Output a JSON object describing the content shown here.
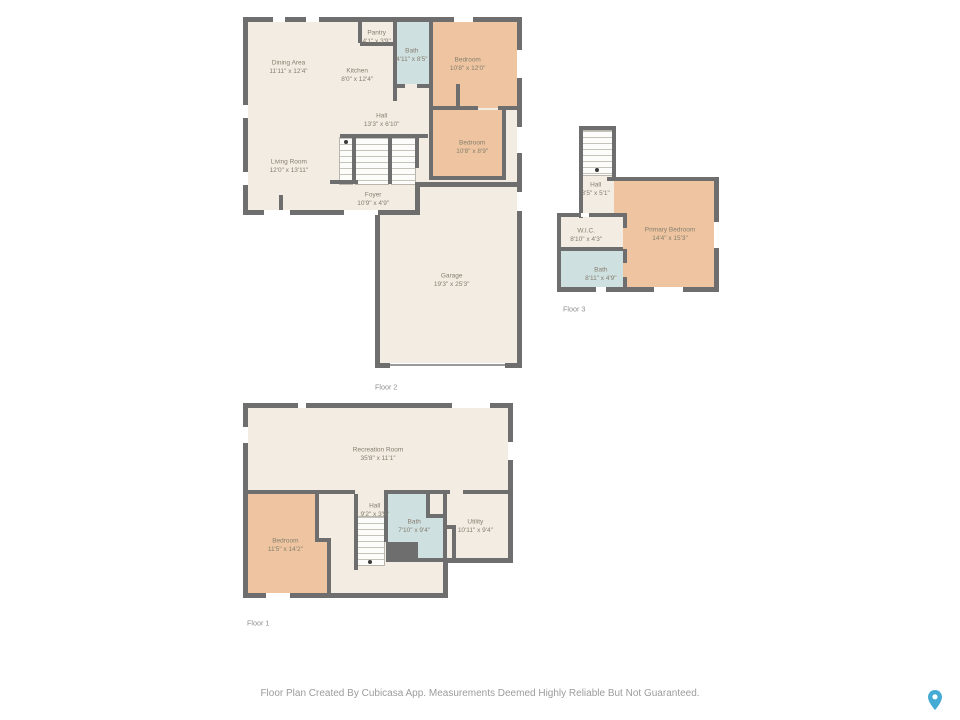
{
  "document": {
    "type": "floor-plan"
  },
  "palette": {
    "wall": "#6e6e6e",
    "floor": "#f2ece3",
    "bedroom_fill": "#eec5a0",
    "bath_fill": "#cfe0e1",
    "room_text": "#857e6e",
    "floor_label_text": "#8f8f8f",
    "footer_text": "#9c9c9c",
    "pin_color": "#45aad4"
  },
  "floors": [
    {
      "label": "Floor 2",
      "rooms": [
        {
          "name": "Dining Area",
          "dims": "11'11\" x 12'4\""
        },
        {
          "name": "Kitchen",
          "dims": "8'0\" x 12'4\""
        },
        {
          "name": "Pantry",
          "dims": "4'1\" x 3'9\""
        },
        {
          "name": "Bath",
          "dims": "4'11\" x 8'5\""
        },
        {
          "name": "Bedroom",
          "dims": "10'8\" x 12'0\""
        },
        {
          "name": "Hall",
          "dims": "13'3\" x 6'10\""
        },
        {
          "name": "Bedroom",
          "dims": "10'8\" x 8'9\""
        },
        {
          "name": "Living Room",
          "dims": "12'0\" x 13'11\""
        },
        {
          "name": "Foyer",
          "dims": "10'9\" x 4'9\""
        },
        {
          "name": "Garage",
          "dims": "19'3\" x 25'3\""
        }
      ]
    },
    {
      "label": "Floor 3",
      "rooms": [
        {
          "name": "Hall",
          "dims": "3'5\" x 5'1\""
        },
        {
          "name": "Primary Bedroom",
          "dims": "14'4\" x 15'3\""
        },
        {
          "name": "W.I.C.",
          "dims": "8'10\" x 4'3\""
        },
        {
          "name": "Bath",
          "dims": "8'11\" x 4'9\""
        }
      ]
    },
    {
      "label": "Floor 1",
      "rooms": [
        {
          "name": "Recreation Room",
          "dims": "35'8\" x 11'1\""
        },
        {
          "name": "Bedroom",
          "dims": "11'5\" x 14'2\""
        },
        {
          "name": "Hall",
          "dims": "9'2\" x 3'5\""
        },
        {
          "name": "Bath",
          "dims": "7'10\" x 9'4\""
        },
        {
          "name": "Utility",
          "dims": "10'11\" x 9'4\""
        }
      ]
    }
  ],
  "footer": {
    "disclaimer": "Floor Plan Created By Cubicasa App. Measurements Deemed Highly Reliable But Not Guaranteed."
  }
}
